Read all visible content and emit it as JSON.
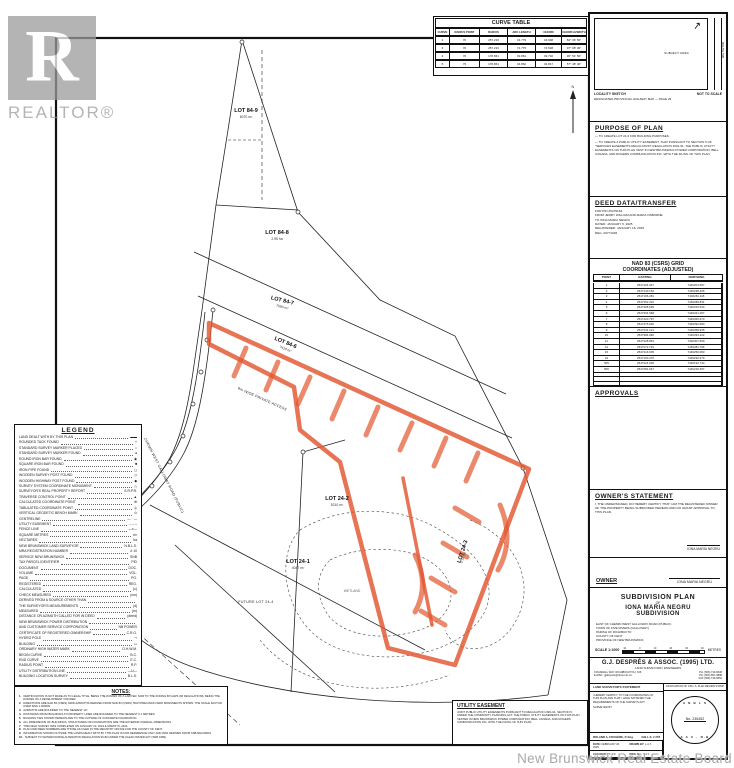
{
  "watermarks": {
    "realtor_r": "R",
    "realtor": "REALTOR®",
    "board": "New Brunswick Real Estate Board"
  },
  "curve_table": {
    "title": "CURVE TABLE",
    "headers": [
      "CURVE",
      "RADIUS POINT",
      "RADIUS",
      "ARC LENGTH",
      "CHORD",
      "CHORD AZIMUTH"
    ],
    "rows": [
      [
        "2",
        "70",
        "257.216",
        "34.779",
        "34.698",
        "84° 36' 50\""
      ],
      [
        "3",
        "70",
        "257.216",
        "74.775",
        "74.528",
        "97° 08' 30\""
      ],
      [
        "4",
        "76",
        "178.861",
        "39.864",
        "39.792",
        "36° 54' 50\""
      ],
      [
        "5",
        "76",
        "178.861",
        "34.862",
        "34.817",
        "57° 48' 40\""
      ]
    ]
  },
  "locality": {
    "heading_left": "LOCALITY SKETCH",
    "heading_right": "NOT TO SCALE",
    "subheading": "DESIGNATED PROVINCIAL HIGHWAY MAP — PAGE 29",
    "area_label": "SUBJECT AREA",
    "route_label": "ROUTE 505",
    "north_arrow": "↗"
  },
  "purpose": {
    "title": "PURPOSE OF PLAN",
    "items": [
      "— TO CREATE LOT 24-3 FOR BUILDING PURPOSES.",
      "— TO CREATE A PUBLIC UTILITY EASEMENT, THAT PURSUANT TO SECTION 5 OF \"SERVICES EASEMENTS REGULATION\" REGULATION 2001-91, THE PUBLIC UTILITY EASEMENTS ON THIS PLAN VEST IN NEW BRUNSWICK POWER CORPORATION, BELL CANADA, AND ROGERS COMMUNICATION INC. WITH THE FILING OF THIS PLAN."
    ]
  },
  "deed": {
    "title": "DEED DATA/TRANSFER",
    "lines": [
      "FOR PID 25479154",
      "FROM JERRY WILLIAM AND MARIA OSBORNE",
      "TO IONA MARIA NEGRU",
      "DATED: JANUARY 5, 2025",
      "REGISTERED: JANUARY 16, 2025",
      "REG. 29771046"
    ]
  },
  "coords": {
    "title_line1": "NAD 83 (CSRS) GRID",
    "title_line2": "COORDINATES (ADJUSTED)",
    "headers": [
      "POINT",
      "EASTING",
      "NORTHING"
    ],
    "rows": [
      [
        "1",
        "2547104.347",
        "7446204.657"
      ],
      [
        "2",
        "2547140.152",
        "7446238.405"
      ],
      [
        "3",
        "2547196.281",
        "7446264.118"
      ],
      [
        "4",
        "2547252.410",
        "7446289.831"
      ],
      [
        "5",
        "2547308.539",
        "7446315.544"
      ],
      [
        "6",
        "2547364.668",
        "7446341.257"
      ],
      [
        "7",
        "2547420.797",
        "7446366.970"
      ],
      [
        "8",
        "2547476.926",
        "7446392.683"
      ],
      [
        "9",
        "2547441.121",
        "7446358.935"
      ],
      [
        "10",
        "2547384.992",
        "7446333.222"
      ],
      [
        "11",
        "2547328.863",
        "7446307.509"
      ],
      [
        "12",
        "2547272.734",
        "7446281.796"
      ],
      [
        "15",
        "2547216.605",
        "7446256.083"
      ],
      [
        "16",
        "2547160.476",
        "7446230.370"
      ],
      [
        "505",
        "2547224.918",
        "7446192.744"
      ],
      [
        "506",
        "2547281.047",
        "7446218.457"
      ],
      [
        "",
        "",
        ""
      ],
      [
        "",
        "",
        ""
      ],
      [
        "",
        "",
        ""
      ]
    ],
    "footnote": "▲  RADIUS POINT"
  },
  "approvals": {
    "title": "APPROVALS"
  },
  "owner_statement": {
    "title": "OWNER'S STATEMENT",
    "text": "I, THE UNDERSIGNED, DO HEREBY CERTIFY THAT I AM THE REGISTERED OWNER OF THE PROPERTY BEING SUBDIVIDED HEREON AND DO GRANT APPROVAL TO THIS PLAN.",
    "signature": "IONA MARIA NEGRU"
  },
  "owner_row": {
    "label": "OWNER",
    "signature": "IONA MARIA NEGRU"
  },
  "title_block": {
    "plan_title_lines": [
      "SUBDIVISION PLAN",
      "OF",
      "IONA MARIA NEGRU",
      "SUBDIVISION"
    ],
    "location_lines": [
      "EAST OF CHEMIN WEST GALLOWAY ROAD (PUBLIC)",
      "TOWN OF FIVE RIVERS (GALLOWAY)",
      "PARISH OF RICHIBUCTO",
      "COUNTY OF KENT",
      "PROVINCE OF NEW BRUNSWICK"
    ],
    "scale_label": "SCALE 1:1000",
    "scale_units": "METRES",
    "scale_ticks": [
      "10",
      "0",
      "10",
      "20",
      "30",
      "40"
    ],
    "firm": {
      "name": "G.J. DESPRÉS & ASSOC. (1995) LTD.",
      "subtitle": "LAND SURVEYORS / ENGINEERS",
      "address": "9 RANDALL WAY, RICHIBOUCTOU, N.B.",
      "email": "E-MAIL: gjdespres@nbnet.nb.ca",
      "phones": [
        "PH.  (506) 743-8438",
        "PH.  (506) 857-0898",
        "FAX  (506) 743-8454"
      ]
    },
    "statement": {
      "title": "LAND SURVEYOR'S STATEMENT",
      "text": "I HEREBY CERTIFY, TO THE COORDINATES OF THIS PLAN AND THAT I HAVE SATISFIED THE REQUIREMENTS OF THE SURVEYS ACT.",
      "surveyed_by": "SURVEYED BY",
      "surveyor": "ROLAND A. FOUGÈRE, P. Eng.",
      "license": "N.B.L.S. # 278",
      "fields": [
        {
          "label": "DATE:",
          "value": "FEBRUARY 26, 2025"
        },
        {
          "label": "DRAWN BY:",
          "value": "L.A.T."
        },
        {
          "label": "CHECKED BY:",
          "value": "R.F."
        },
        {
          "label": "DWG. No.:",
          "value": "1 of 1"
        }
      ]
    },
    "stamp": {
      "title": "ASSOCIATION OF N.B.L.S. PLAN REVIEW STAMP",
      "arc_top": "A N B L S",
      "number": "No. 235452",
      "arc_bottom": "A A C · N-B"
    }
  },
  "legend": {
    "title": "LEGEND",
    "items": [
      {
        "label": "LAND DEALT WITH BY THIS PLAN",
        "sym": "▬▬"
      },
      {
        "label": "ROUNDED TACK FOUND",
        "sym": "+"
      },
      {
        "label": "STANDARD SURVEY MARKER PLACED",
        "sym": "○"
      },
      {
        "label": "STANDARD SURVEY MARKER FOUND",
        "sym": "●"
      },
      {
        "label": "ROUND IRON BAR FOUND",
        "sym": "◉"
      },
      {
        "label": "SQUARE IRON BAR FOUND",
        "sym": "■"
      },
      {
        "label": "IRON PIPE FOUND",
        "sym": "◻"
      },
      {
        "label": "WOODEN SURVEY POST FOUND",
        "sym": "◇"
      },
      {
        "label": "WOODEN HIGHWAY POST FOUND",
        "sym": "◆"
      },
      {
        "label": "SURVEY SYSTEM COORDINATE MONUMENT",
        "sym": "△"
      },
      {
        "label": "SURVEYOR'S REAL PROPERTY REPORT",
        "sym": "S.R.P.R."
      },
      {
        "label": "TRAVERSE CONTROL POINT",
        "sym": "▲"
      },
      {
        "label": "CALCULATED COORDINATE POINT",
        "sym": "⊕"
      },
      {
        "label": "TABULATED COORDINATE POINT",
        "sym": "◎"
      },
      {
        "label": "VERTICAL GEODETIC BENCH MARK",
        "sym": "⊙"
      },
      {
        "label": "CENTRELINE",
        "sym": "— · —"
      },
      {
        "label": "UTILITY EASEMENT",
        "sym": "– – –"
      },
      {
        "label": "FENCE LINE",
        "sym": "—x—"
      },
      {
        "label": "SQUARE METRES",
        "sym": "m²"
      },
      {
        "label": "HECTARES",
        "sym": "ha"
      },
      {
        "label": "NEW BRUNSWICK LAND SURVEYOR",
        "sym": "N.B.L.S."
      },
      {
        "label": "MRA REGISTRATION NUMBER",
        "sym": "# 10"
      },
      {
        "label": "SERVICE NEW BRUNSWICK",
        "sym": "SNB"
      },
      {
        "label": "TAX PARCEL IDENTIFIER",
        "sym": "PID"
      },
      {
        "label": "DOCUMENT",
        "sym": "DOC."
      },
      {
        "label": "VOLUME",
        "sym": "VOL."
      },
      {
        "label": "PAGE",
        "sym": "PG."
      },
      {
        "label": "REGISTERED",
        "sym": "REG."
      },
      {
        "label": "CALCULATED",
        "sym": "(c)"
      },
      {
        "label": "CHECK MEASURED",
        "sym": "(cm)"
      },
      {
        "label": "DERIVED FROM A SOURCE OTHER THAN",
        "sym": ""
      },
      {
        "label": "THE SURVEYOR'S MEASUREMENTS",
        "sym": "(d)"
      },
      {
        "label": "MEASURED",
        "sym": "(m)"
      },
      {
        "label": "DISTANCE OR AZIMUTH CALLED FOR IN DEED",
        "sym": "(deed)"
      },
      {
        "label": "NEW BRUNSWICK POWER DISTRIBUTION",
        "sym": ""
      },
      {
        "label": "AND CUSTOMER SERVICE CORPORATION",
        "sym": "NB POWER"
      },
      {
        "label": "CERTIFICATE OF REGISTERED OWNERSHIP",
        "sym": "C.R.O."
      },
      {
        "label": "HYDRO POLE",
        "sym": "⊸"
      },
      {
        "label": "BUILDING",
        "sym": "▭"
      },
      {
        "label": "ORDINARY HIGH WATER MARK",
        "sym": "O.H.W.M."
      },
      {
        "label": "BEGIN CURVE",
        "sym": "B.C."
      },
      {
        "label": "END CURVE",
        "sym": "E.C."
      },
      {
        "label": "RADIUS POINT",
        "sym": "R.P."
      },
      {
        "label": "UTILITY DISTRIBUTION LINE",
        "sym": "—U—"
      },
      {
        "label": "BUILDING LOCATION SURVEY",
        "sym": "B.L.S."
      }
    ]
  },
  "notes": {
    "title": "NOTES:",
    "items": [
      "CERTIFICATION IS NOT MADE AS TO LEGAL TITLE, BEING THE DOMAIN OF A LAWYER, NOR TO THE ZONING BYLAWS OR REGULATIONS, BEING THE DOMAIN OF A DEVELOPMENT OFFICER.",
      "DIRECTIONS ARE NAD 83 (CSRS) GRID AZIMUTHS DERIVED FROM NAD 83 (CSRS) HIGH PRECISION GRID MONUMENTS SHOWN. THE SCALE FACTOR USED WAS 1.000000.",
      "AZIMUTHS ARE ROUNDED TO THE NEAREST 10\".",
      "DISTANCES FROM BUILDINGS TO PROPERTY LINES ARE ROUNDED TO THE NEAREST 0.1 METRES.",
      "BUILDING TIES SHOWN HEREON ARE TO THE OUTSIDE OF CONCRETE FOUNDATION.",
      "ALL DIMENSIONS OF BUILDINGS, STRUCTURES OR FOUNDATIONS ARE THE EXTERIOR OVERALL DIMENSIONS.",
      "THE FIELD SURVEY WAS COMPLETED ON JANUARY 22, 2024 & MARCH 5, 2024.",
      "PLAN AND DEED NUMBERS ARE THOSE AS FILED IN THE REGISTRY OFFICE FOR THE COUNTY OF KENT.",
      "INFORMATION SHOWN OUTSIDE THE LANDS DEALT WITH BY THIS PLAN IS FOR REFERENCE ONLY AND WAS DERIVED FROM SNB RECORDS.",
      "SUBJECT TO WATERCOURSE ALTERATION REGULATION 90-80 UNDER THE CLEAN WATER ACT (SNB 1989)."
    ]
  },
  "utility": {
    "title": "UTILITY EASEMENT",
    "text": "JOINT PUBLIC UTILITY EASEMENTS PURSUANT TO REGULATION 2001-91, SECTION 5, UNDER THE COMMUNITY PLANNING ACT. THE PUBLIC UTILITY EASEMENTS ON THIS PLAN VESTED IN NEW BRUNSWICK POWER CORPORATION, BELL CANADA, AND ROGERS COMMUNICATION INC. WITH THE FILING OF THIS PLAN."
  },
  "map": {
    "highlight_color": "#e2572f",
    "labels": [
      {
        "text": "LOT 84-9",
        "sub": "6070 m²",
        "x": 246,
        "y": 112,
        "rot": 0
      },
      {
        "text": "LOT 84-8",
        "sub": "2.95 ha",
        "x": 277,
        "y": 234,
        "rot": 0
      },
      {
        "text": "LOT 84-7",
        "sub": "7590 m²",
        "x": 282,
        "y": 302,
        "rot": 14
      },
      {
        "text": "LOT 84-6",
        "sub": "7410 m²",
        "x": 285,
        "y": 344,
        "rot": 22
      },
      {
        "text": "LOT 24-2",
        "sub": "5210 m²",
        "x": 337,
        "y": 500,
        "rot": 0
      },
      {
        "text": "LOT 24-1",
        "sub": "4047 m²",
        "x": 298,
        "y": 563,
        "rot": 0
      },
      {
        "text": "FUTURE LOT 24-4",
        "sub": "",
        "x": 256,
        "y": 603,
        "rot": 0,
        "cls": "sm"
      },
      {
        "text": "LOT 24-3",
        "sub": "2.18 ha",
        "x": 464,
        "y": 552,
        "rot": -72
      },
      {
        "text": "8m WIDE PRIVATE ACCESS",
        "sub": "",
        "x": 262,
        "y": 400,
        "rot": 24,
        "cls": "sm"
      },
      {
        "text": "CHEMIN WEST GALLOWAY ROAD (PUBLIC)",
        "sub": "",
        "x": 163,
        "y": 476,
        "rot": 63,
        "cls": "sm"
      },
      {
        "text": "WETLAND",
        "sub": "",
        "x": 352,
        "y": 592,
        "rot": 0,
        "cls": "lt"
      },
      {
        "text": "N",
        "sub": "",
        "x": 573,
        "y": 88,
        "rot": 0,
        "cls": "sm"
      }
    ]
  }
}
